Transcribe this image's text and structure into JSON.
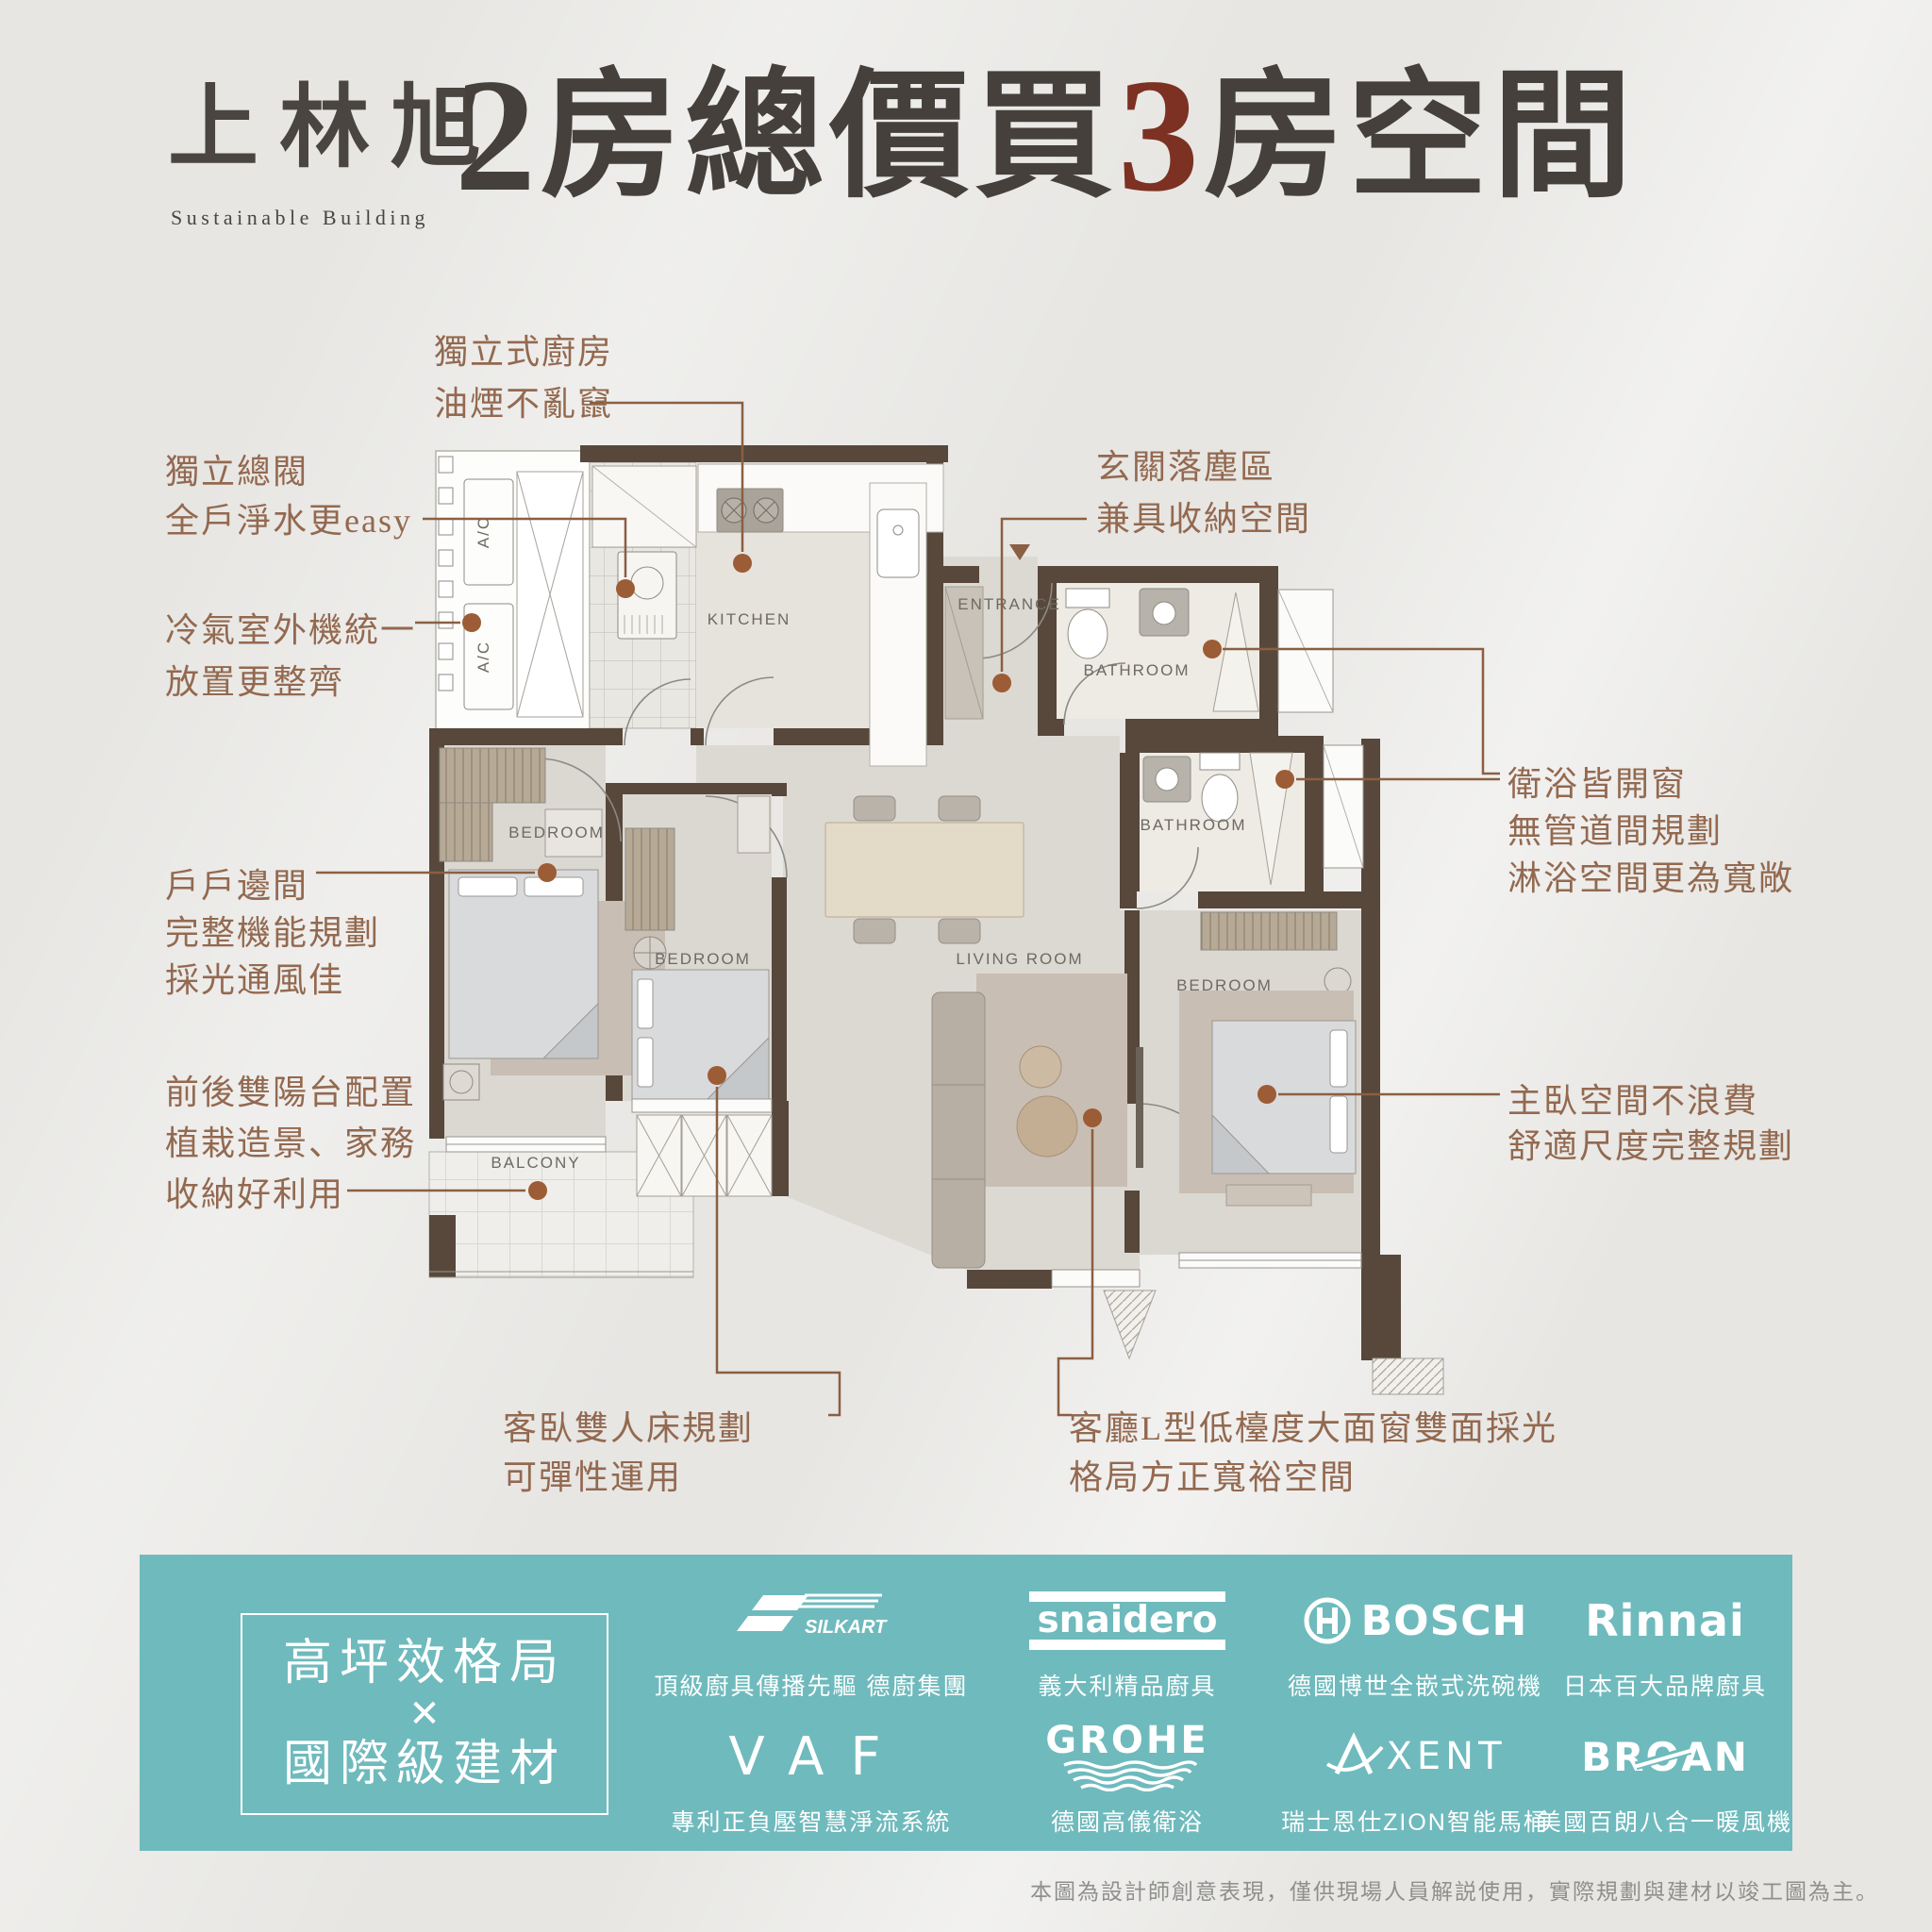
{
  "logo": {
    "title": "上林旭",
    "subtitle": "Sustainable Building"
  },
  "headline": {
    "num1": "2",
    "mid": "房總價買",
    "num2": "3",
    "tail": "房空間"
  },
  "plan": {
    "rooms": {
      "kitchen": "KITCHEN",
      "entrance": "ENTRANCE",
      "bathroom_a": "BATHROOM",
      "bathroom_b": "BATHROOM",
      "bedroom_left": "BEDROOM",
      "bedroom_mid": "BEDROOM",
      "bedroom_master": "BEDROOM",
      "living": "LIVING ROOM",
      "balcony": "BALCONY"
    },
    "ac_label": "A/C"
  },
  "annotations": {
    "kitchen": {
      "line1": "獨立式廚房",
      "line2": "油煙不亂竄"
    },
    "valve": {
      "line1": "獨立總閥",
      "line2": "全戶淨水更easy"
    },
    "ac": {
      "line1": "冷氣室外機統一",
      "line2": "放置更整齊"
    },
    "corner": {
      "line1": "戶戶邊間",
      "line2": "完整機能規劃",
      "line3": "採光通風佳"
    },
    "balcony": {
      "line1": "前後雙陽台配置",
      "line2": "植栽造景、家務",
      "line3": "收納好利用"
    },
    "entry": {
      "line1": "玄關落塵區",
      "line2": "兼具收納空間"
    },
    "bath": {
      "line1": "衛浴皆開窗",
      "line2": "無管道間規劃",
      "line3": "淋浴空間更為寬敞"
    },
    "master": {
      "line1": "主臥空間不浪費",
      "line2": "舒適尺度完整規劃"
    },
    "guest": {
      "line1": "客臥雙人床規劃",
      "line2": "可彈性運用"
    },
    "livingroom": {
      "line1": "客廳L型低檯度大面窗雙面採光",
      "line2": "格局方正寬裕空間"
    }
  },
  "banner": {
    "slogan": {
      "line1": "高坪效格局",
      "times": "✕",
      "line2": "國際級建材"
    },
    "brands": [
      {
        "logo": "SILKART",
        "tagline": "頂級廚具傳播先驅 德廚集團"
      },
      {
        "logo": "snaidero",
        "tagline": "義大利精品廚具"
      },
      {
        "logo": "BOSCH",
        "tagline": "德國博世全嵌式洗碗機"
      },
      {
        "logo": "Rinnai",
        "tagline": "日本百大品牌廚具"
      },
      {
        "logo": "VAF",
        "tagline": "專利正負壓智慧淨流系統"
      },
      {
        "logo": "GROHE",
        "tagline": "德國高儀衛浴"
      },
      {
        "logo_a": "A",
        "logo_rest": "XENT",
        "tagline": "瑞士恩仕ZION智能馬桶"
      },
      {
        "logo_pre": "BR",
        "logo_o": "O",
        "logo_post": "AN",
        "tagline": "美國百朗八合一暖風機"
      }
    ]
  },
  "disclaimer": "本圖為設計師創意表現，僅供現場人員解説使用，實際規劃與建材以竣工圖為主。",
  "colors": {
    "accent_teal": "#6fbabd",
    "annotation_brown": "#936950",
    "headline_red": "#7c3122",
    "wall_brown": "#57483b"
  }
}
